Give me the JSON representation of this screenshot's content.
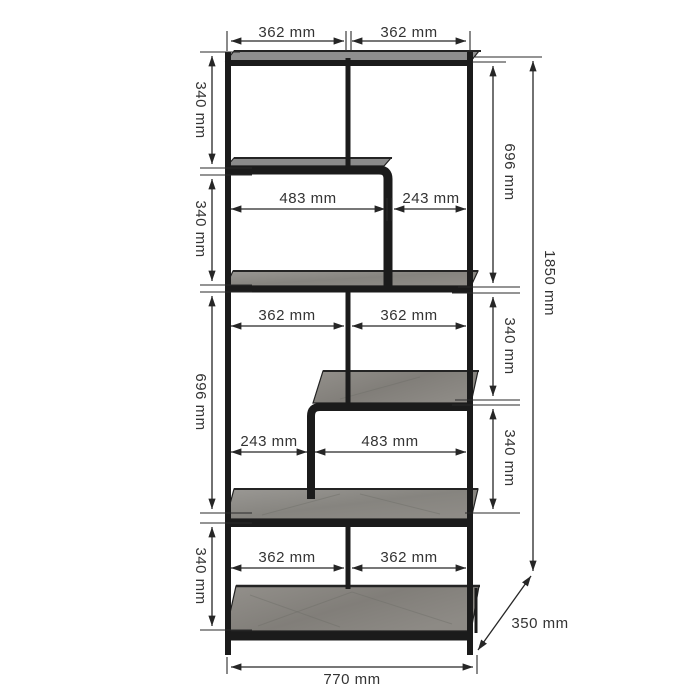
{
  "diagram": {
    "dims": {
      "top_widths": [
        "362 mm",
        "362 mm"
      ],
      "upper_shelf_widths": [
        "483 mm",
        "243 mm"
      ],
      "middle_widths": [
        "362 mm",
        "362 mm"
      ],
      "lower_shelf_widths": [
        "243 mm",
        "483 mm"
      ],
      "bottom_widths": [
        "362 mm",
        "362 mm"
      ],
      "overall_width": "770 mm",
      "overall_depth": "350 mm",
      "overall_height": "1850 mm",
      "left_heights": [
        "340 mm",
        "340 mm",
        "696 mm",
        "340 mm"
      ],
      "right_heights": [
        "696 mm",
        "340 mm",
        "340 mm"
      ]
    },
    "colors": {
      "frame": "#1b1b1b",
      "shelf_wood": "#8d8a84",
      "dimension_lines": "#262626",
      "background": "#ffffff"
    }
  }
}
